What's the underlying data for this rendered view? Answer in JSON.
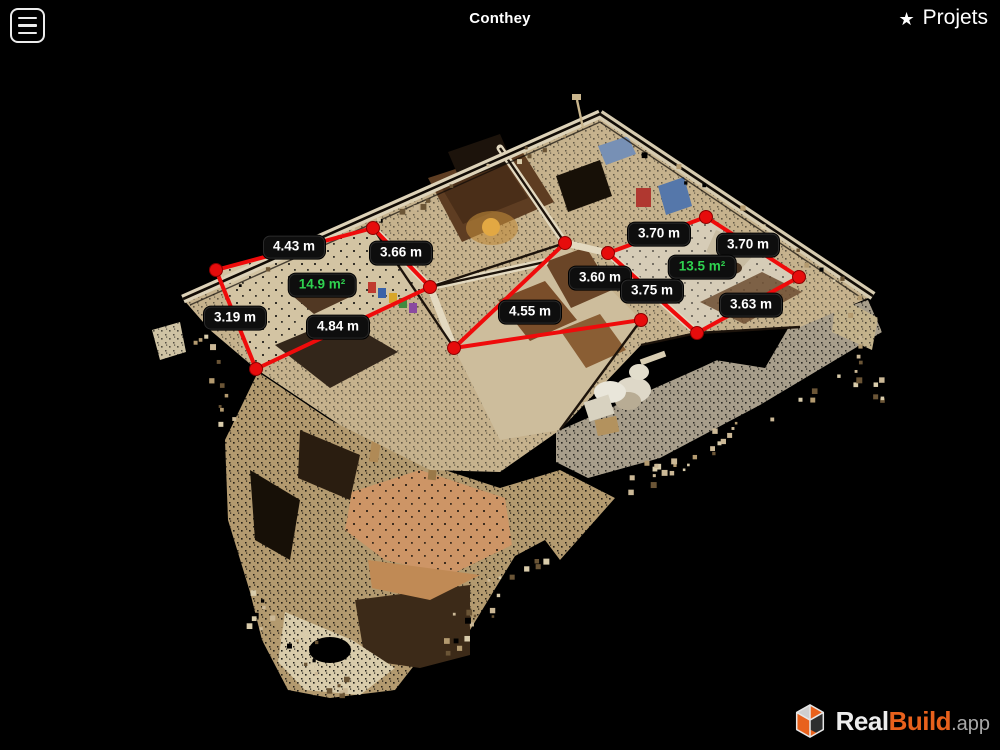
{
  "header": {
    "title": "Conthey",
    "menu_icon": "hamburger",
    "projects": {
      "star": "★",
      "label": "Projets"
    }
  },
  "scene": {
    "description": "3d-dollhouse-point-cloud-scan",
    "area_labels": [
      {
        "text": "14.9 m²",
        "x": 322,
        "y": 285
      },
      {
        "text": "13.5 m²",
        "x": 702,
        "y": 267
      }
    ],
    "measurements": [
      {
        "text": "4.43 m",
        "x": 294,
        "y": 247
      },
      {
        "text": "3.66 m",
        "x": 401,
        "y": 253
      },
      {
        "text": "3.19 m",
        "x": 235,
        "y": 318
      },
      {
        "text": "4.84 m",
        "x": 338,
        "y": 327
      },
      {
        "text": "3.60 m",
        "x": 600,
        "y": 278
      },
      {
        "text": "4.55 m",
        "x": 530,
        "y": 312
      },
      {
        "text": "3.70 m",
        "x": 659,
        "y": 234
      },
      {
        "text": "3.70 m",
        "x": 748,
        "y": 245
      },
      {
        "text": "3.75 m",
        "x": 652,
        "y": 291
      },
      {
        "text": "3.63 m",
        "x": 751,
        "y": 305
      }
    ],
    "lines": [
      [
        216,
        270,
        373,
        228
      ],
      [
        373,
        228,
        430,
        287
      ],
      [
        216,
        270,
        256,
        369
      ],
      [
        256,
        369,
        430,
        287
      ],
      [
        565,
        243,
        454,
        348
      ],
      [
        454,
        348,
        641,
        320
      ],
      [
        608,
        253,
        706,
        217
      ],
      [
        706,
        217,
        799,
        277
      ],
      [
        608,
        253,
        697,
        333
      ],
      [
        697,
        333,
        799,
        277
      ]
    ],
    "dots": [
      [
        216,
        270
      ],
      [
        373,
        228
      ],
      [
        430,
        287
      ],
      [
        256,
        369
      ],
      [
        565,
        243
      ],
      [
        454,
        348
      ],
      [
        641,
        320
      ],
      [
        608,
        253
      ],
      [
        706,
        217
      ],
      [
        799,
        277
      ],
      [
        697,
        333
      ]
    ],
    "colors": {
      "measure_line": "#ef0b0b",
      "measure_dot": "#e60c0c",
      "label_bg": "#0e0e0e",
      "label_text": "#ffffff",
      "area_text": "#2fd24f"
    }
  },
  "logo": {
    "icon": "realbuild-cube",
    "part1": "Real",
    "part2": "Build",
    "part3": ".app",
    "brand_orange": "#e8611c"
  }
}
